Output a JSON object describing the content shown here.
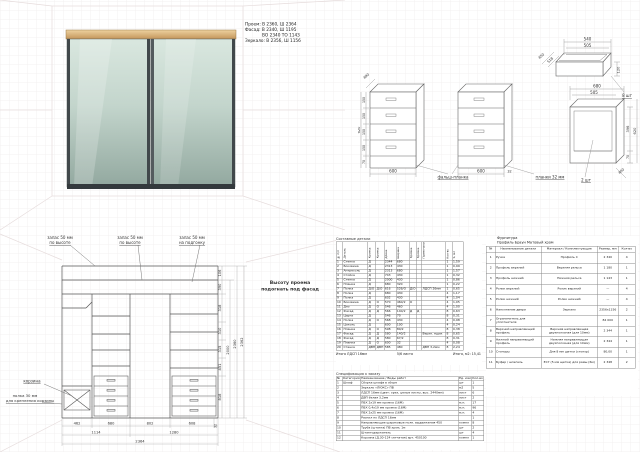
{
  "title_block": {
    "line1": "Проем:  В 2360,  Ш 2364",
    "line2": "Фасад:  В 2340,  Ш 1195",
    "line3": "ВО 2340   ТО 1143",
    "line4": "Зеркало: В 2356, Ш 1156"
  },
  "iso": {
    "drawer_box": {
      "dim_top": "540",
      "dim_top2": "505",
      "dim_left_outer": "450",
      "dim_left_inner": "518",
      "dim_height": "120",
      "qty": "8 шт"
    },
    "chest_left": {
      "dim_depth": "490",
      "dim_height_total": "620",
      "seg1": "150",
      "seg2": "150",
      "seg3": "150",
      "seg4": "150",
      "seg5": "70",
      "dim_width": "600",
      "callout": "фальш-планка"
    },
    "chest_right": {
      "dim_width": "600",
      "dim_gap": "32",
      "callout": "планки 32 мм"
    },
    "cabinet": {
      "dim_top": "680",
      "dim_top2": "505",
      "dim_inner_h": "396",
      "dim_h": "620",
      "dim_base": "70",
      "dim_depth": "400",
      "qty": "2 шт"
    }
  },
  "elevation": {
    "label1_l1": "запас 50 мм",
    "label1_l2": "по высоте",
    "label2_l1": "запас 50 мм",
    "label2_l2": "по высоте",
    "label3_l1": "запас 50 мм",
    "label3_l2": "на подгонку",
    "note_l1": "Высоту проема",
    "note_l2": "подогнать под фасад",
    "basket_label": "корзина",
    "shelf_label_l1": "полка 30 мм",
    "shelf_label_l2": "для крепления корзины",
    "seg": [
      "106",
      "390",
      "318",
      "310",
      "315",
      "451",
      "818"
    ],
    "total_inner": "2000",
    "total_mid": "2360",
    "total_outer": "2362",
    "row1": [
      "462",
      "680",
      "802",
      "608",
      "32"
    ],
    "row2": [
      "1114",
      "1280"
    ],
    "total_width": "2364"
  },
  "cutlist": {
    "title": "Составные детали",
    "headers": [
      "№ п/п",
      "Деталь",
      "Кромка",
      "Кромка",
      "Длина",
      "Ширина",
      "Кромка",
      "Кромка",
      "Примечание",
      "Кол-во",
      "S, м2"
    ],
    "rows": [
      [
        "1",
        "Стенка",
        "Д",
        "",
        "2344",
        "680",
        "",
        "",
        "",
        "1",
        "1,59"
      ],
      [
        "2",
        "Боковина",
        "Д",
        "",
        "2313",
        "430",
        "",
        "",
        "",
        "1",
        "0,99"
      ],
      [
        "3",
        "Антресоль",
        "Д",
        "",
        "2313",
        "680",
        "",
        "",
        "",
        "1",
        "1,57"
      ],
      [
        "4",
        "Стойка",
        "Д",
        "",
        "743",
        "430",
        "",
        "",
        "",
        "1",
        "0,32"
      ],
      [
        "5",
        "Стенка",
        "Д",
        "",
        "2000",
        "430",
        "",
        "",
        "",
        "1",
        "0,86"
      ],
      [
        "6",
        "Планка",
        "Д",
        "",
        "680",
        "320",
        "",
        "",
        "",
        "1",
        "0,22"
      ],
      [
        "7",
        "Полка",
        "Д/О",
        "Д/О",
        "616",
        "526/О",
        "Д/О",
        "",
        "ЛДСП 26мм",
        "1",
        "0,65"
      ],
      [
        "8",
        "Полка",
        "Д",
        "",
        "680",
        "430",
        "",
        "",
        "",
        "4",
        "1,17"
      ],
      [
        "9",
        "Полка",
        "Д",
        "",
        "602",
        "430",
        "",
        "",
        "",
        "4",
        "1,04"
      ],
      [
        "10",
        "Боковина",
        "Д",
        "О",
        "570",
        "460/2",
        "О",
        "",
        "",
        "4",
        "1,05"
      ],
      [
        "11",
        "Дно",
        "Д",
        "О",
        "546",
        "460",
        "",
        "",
        "",
        "4",
        "1,00"
      ],
      [
        "12",
        "Фасад",
        "Д",
        "Д",
        "566",
        "140/2",
        "Д",
        "Д",
        "",
        "8",
        "0,63"
      ],
      [
        "13",
        "Царга",
        "Д",
        "",
        "546",
        "70",
        "",
        "",
        "",
        "8",
        "0,31"
      ],
      [
        "14",
        "Полка",
        "Д",
        "О",
        "568",
        "430",
        "",
        "",
        "",
        "4",
        "0,98"
      ],
      [
        "15",
        "Цоколь",
        "Д",
        "",
        "600",
        "100",
        "",
        "",
        "",
        "4",
        "0,24"
      ],
      [
        "16",
        "Планка",
        "Д",
        "О",
        "598",
        "80/2",
        "",
        "",
        "",
        "8",
        "0,38"
      ],
      [
        "17",
        "Фасад",
        "Д",
        "Д",
        "580",
        "140/2",
        "",
        "",
        "Верхн. ящик",
        "8",
        "0,65"
      ],
      [
        "18",
        "Фасад",
        "Д",
        "Д",
        "580",
        "67/2",
        "",
        "",
        "",
        "8",
        "0,31"
      ],
      [
        "19",
        "Планка",
        "Д",
        "О",
        "600",
        "32",
        "",
        "",
        "",
        "4",
        "0,08"
      ],
      [
        "20",
        "Стенка",
        "ДВП",
        "ДВП",
        "585",
        "480",
        "",
        "",
        "ДВП 3,2мм",
        "8",
        "2,24"
      ]
    ],
    "footer_left": "Итого ЛДСП 16мм",
    "footer_mid": "5/6 листа",
    "footer_right": "Итого, м2:   15,41"
  },
  "order": {
    "title": "Спецификация к заказу",
    "headers": [
      "№",
      "Категория",
      "Наименование / Виды работ",
      "Ед. изм",
      "Кол-во"
    ],
    "rows": [
      [
        "1",
        "Шкаф",
        "Сборка шкафа в сборе",
        "шт",
        "1"
      ],
      [
        "2",
        "",
        "Зеркало «ЛЮКС» ПВ",
        "м2",
        "5"
      ],
      [
        "3",
        "",
        "ЛДСП 16мм (цвет: орех, целые листы, выс. 2440мм)",
        "лист",
        "6"
      ],
      [
        "4",
        "",
        "ДВП белая 3,2мм",
        "лист",
        "2"
      ],
      [
        "5",
        "",
        "ПВХ 2х19 мм кромка (16М)",
        "м.п.",
        "17"
      ],
      [
        "6",
        "",
        "ПВХ 0,4х19 мм кромка (16М)",
        "м.п.",
        "96"
      ],
      [
        "7",
        "",
        "ПВХ 2х25 мм кромка (16М)",
        "м.п.",
        "4"
      ],
      [
        "8",
        "",
        "Распил по ЛДСП 16мм",
        "",
        "1"
      ],
      [
        "9",
        "",
        "Направляющие шариковые полн. выдвижения 450",
        "компл",
        "8"
      ],
      [
        "10",
        "",
        "Труба (штанга) ПВ хром, 1м",
        "шт",
        "2"
      ],
      [
        "11",
        "",
        "Штангодержатель",
        "шт",
        "4"
      ],
      [
        "12",
        "",
        "Корзина (Д.30-124 сетчатая) арт. 450100",
        "компл",
        "1"
      ]
    ]
  },
  "hardware": {
    "title1": "Фурнитура",
    "title2": "Профиль Браун Матовый хром",
    "headers": [
      "№",
      "Наименование детали",
      "Материал / Комплектующие",
      "Размер, мм",
      "Кол-во"
    ],
    "rows": [
      [
        "1",
        "Ручка",
        "Профиль С",
        "2 340",
        "4"
      ],
      [
        "2",
        "Профиль верхний",
        "Верхняя рельса",
        "1 180",
        "1"
      ],
      [
        "3",
        "Профиль нижний",
        "Нижняя рельса",
        "1 143",
        "1"
      ],
      [
        "4",
        "Ролик верхний",
        "Ролик верхний",
        "—",
        "4"
      ],
      [
        "5",
        "Ролик нижний",
        "Ролик нижний",
        "—",
        "4"
      ],
      [
        "6",
        "Наполнение двери",
        "Зеркало",
        "2356х1156",
        "2"
      ],
      [
        "7",
        "Ограничитель для уплотнителя",
        "",
        "84 000",
        "1"
      ],
      [
        "8",
        "Верхний направляющий профиль",
        "Верхняя направляющая двухполозная (для 10мм)",
        "2 344",
        "1"
      ],
      [
        "9",
        "Нижний направляющий профиль",
        "Нижняя направляющая двухполозная (для 10мм)",
        "2 344",
        "1"
      ],
      [
        "10",
        "Стопоры",
        "Для 8 мм щетки (стопор)",
        "80,00",
        "1"
      ],
      [
        "11",
        "Буфер / шлегель",
        "ЕС7 (5 мм щетка) для рамы (6м)",
        "2 348",
        "2"
      ]
    ]
  }
}
